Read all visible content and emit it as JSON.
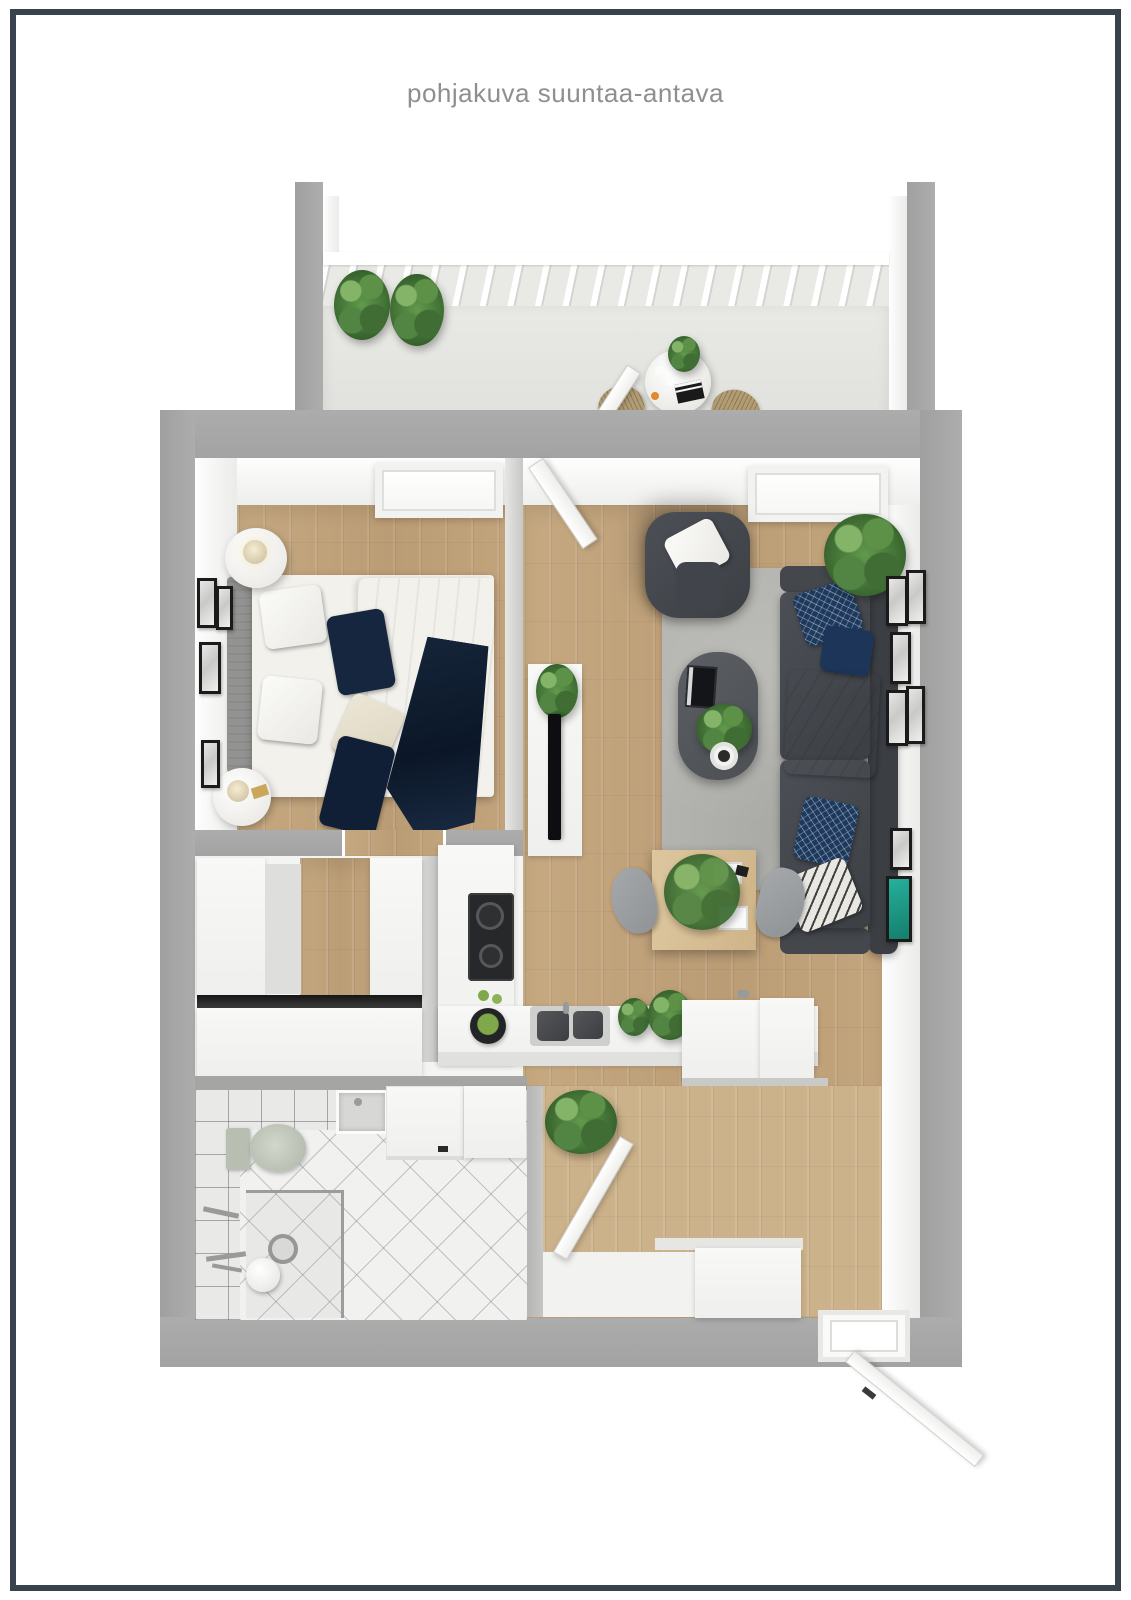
{
  "page": {
    "title": "pohjakuva suuntaa-antava",
    "background": "#ffffff",
    "frame_color": "#39424c",
    "title_color": "#8f8f8f"
  },
  "palette": {
    "outer_wall_gray": "#a8a8a8",
    "interior_white": "#f4f4f2",
    "wood_floor": "#c1a37c",
    "entry_wood": "#ccb28a",
    "balcony_floor": "#e4e4e1",
    "rug_gray": "#b4b4b0",
    "sofa_charcoal": "#45484d",
    "accent_navy": "#1d3150",
    "plant_green": "#4e7f3c",
    "artwork_teal": "#1fa08c",
    "dining_wood": "#d8bf96",
    "bathroom_tile": "#ededec"
  },
  "objects": [
    "balcony",
    "balcony-railing",
    "balcony-plants",
    "bistro-table",
    "wicker-chairs",
    "bedroom",
    "double-bed",
    "headboard",
    "nightstands",
    "table-lamps",
    "bedroom-window",
    "wall-art-frames",
    "living-room",
    "sofa",
    "armchair",
    "coffee-table",
    "area-rug",
    "tv-console",
    "television",
    "fiddle-leaf-plant",
    "gallery-wall",
    "teal-artwork",
    "kitchen",
    "induction-hob",
    "kitchen-sink",
    "fruit-bowl",
    "kitchen-peninsula",
    "dining-table",
    "dining-chairs",
    "hallway-closet",
    "wardrobes",
    "bathroom",
    "toilet",
    "washbasin",
    "washing-machine",
    "shower",
    "floor-drain",
    "entry",
    "shoe-cabinet",
    "front-door",
    "interior-doors"
  ]
}
